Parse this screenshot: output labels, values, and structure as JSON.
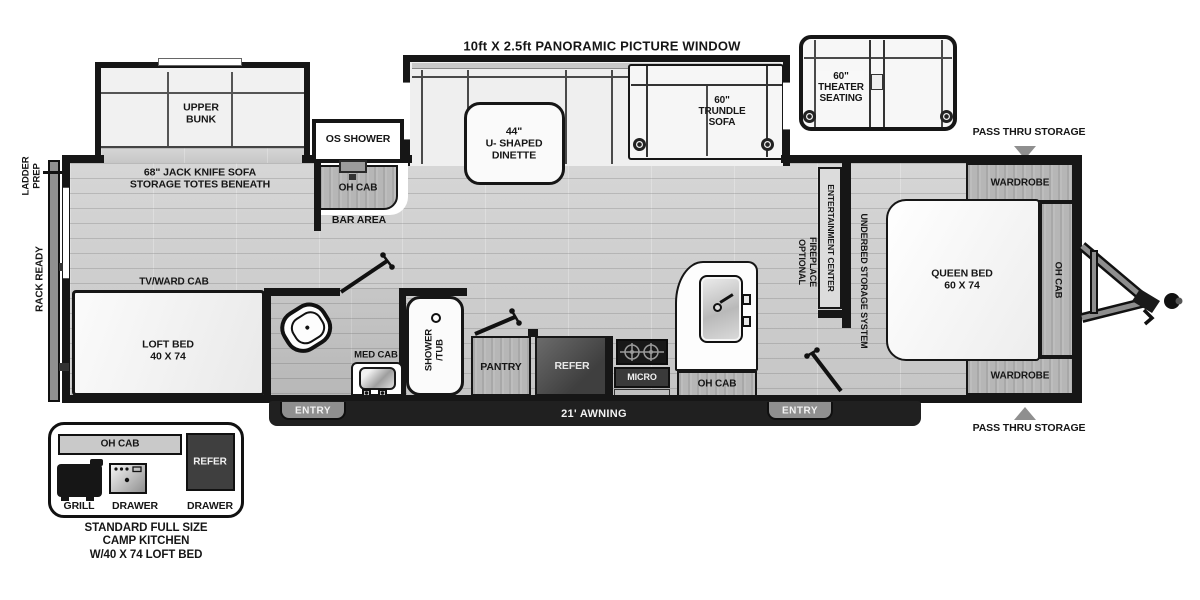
{
  "colors": {
    "wall": "#161616",
    "floor": "#cdcdcd",
    "wood": "#b6b6b6",
    "appliance_dark": "#3f3f3f",
    "awning_bar": "#202020",
    "entry_tab": "#8f8f8f",
    "white_fixture": "#f8f8f8",
    "arrow_gray": "#8f8f8f"
  },
  "labels": {
    "picture_window": "10ft X 2.5ft PANORAMIC PICTURE WINDOW",
    "upper_bunk": "UPPER\nBUNK",
    "jack_knife_sofa": "68\" JACK KNIFE SOFA\nSTORAGE TOTES BENEATH",
    "os_shower": "OS SHOWER",
    "oh_cab_bar": "OH CAB",
    "bar_area": "BAR AREA",
    "dinette": "44\"\nU- SHAPED\nDINETTE",
    "trundle_sofa": "60\"\nTRUNDLE\nSOFA",
    "theater_seating": "60\"\nTHEATER\nSEATING",
    "pass_thru_storage_top": "PASS THRU STORAGE",
    "pass_thru_storage_bottom": "PASS THRU STORAGE",
    "wardrobe_top": "WARDROBE",
    "wardrobe_bottom": "WARDROBE",
    "queen_bed": "QUEEN BED\n60 X 74",
    "oh_cab_bed": "OH CAB",
    "entertainment_center": "ENTERTAINMENT CENTER",
    "optional_fireplace_line1": "OPTIONAL",
    "optional_fireplace_line2": "FIREPLACE",
    "underbed_storage": "UNDERBED STORAGE SYSTEM",
    "ladder_prep": "LADDER\nPREP",
    "rack_ready": "RACK READY",
    "tv_ward_cab": "TV/WARD CAB",
    "loft_bed": "LOFT BED\n40 X 74",
    "med_cab": "MED CAB",
    "shower_tub": "SHOWER\n/TUB",
    "pantry": "PANTRY",
    "refer": "REFER",
    "micro": "MICRO",
    "oh_cab_kitchen": "OH CAB",
    "entry_left": "ENTRY",
    "entry_right": "ENTRY",
    "awning": "21' AWNING"
  },
  "inset": {
    "oh_cab": "OH CAB",
    "refer": "REFER",
    "grill": "GRILL",
    "drawer_left": "DRAWER",
    "drawer_right": "DRAWER",
    "caption": "STANDARD FULL SIZE\nCAMP KITCHEN\nW/40 X 74 LOFT BED"
  }
}
